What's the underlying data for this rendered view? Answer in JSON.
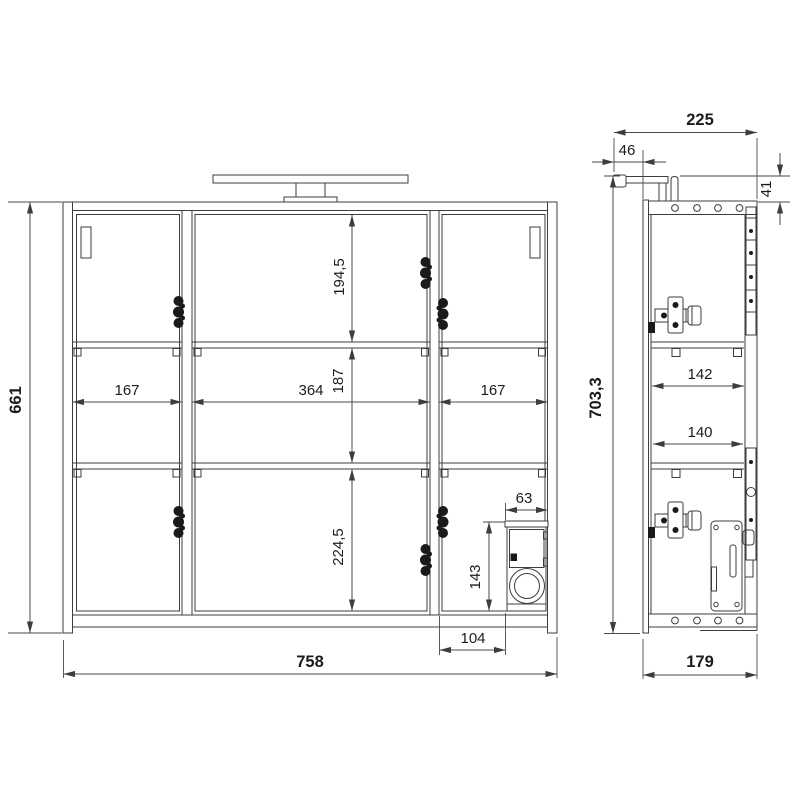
{
  "drawing": {
    "type": "technical-dimension-drawing",
    "subject": "mirror-cabinet-with-light",
    "units_implied": "mm",
    "front_view": {
      "overall_height": "661",
      "overall_width": "758",
      "compartment_width_left": "167",
      "compartment_width_middle": "364",
      "compartment_width_right": "167",
      "bay_height_top": "194,5",
      "bay_height_middle": "187",
      "bay_height_bottom": "224,5",
      "socket_box_width": "63",
      "socket_box_height": "143",
      "socket_box_offset": "104"
    },
    "side_view": {
      "total_depth_with_lamp": "225",
      "lamp_overhang": "46",
      "lamp_height_above_top": "41",
      "total_height_with_lamp": "703,3",
      "inner_depth_upper": "142",
      "inner_depth_lower": "140",
      "body_depth": "179"
    }
  }
}
